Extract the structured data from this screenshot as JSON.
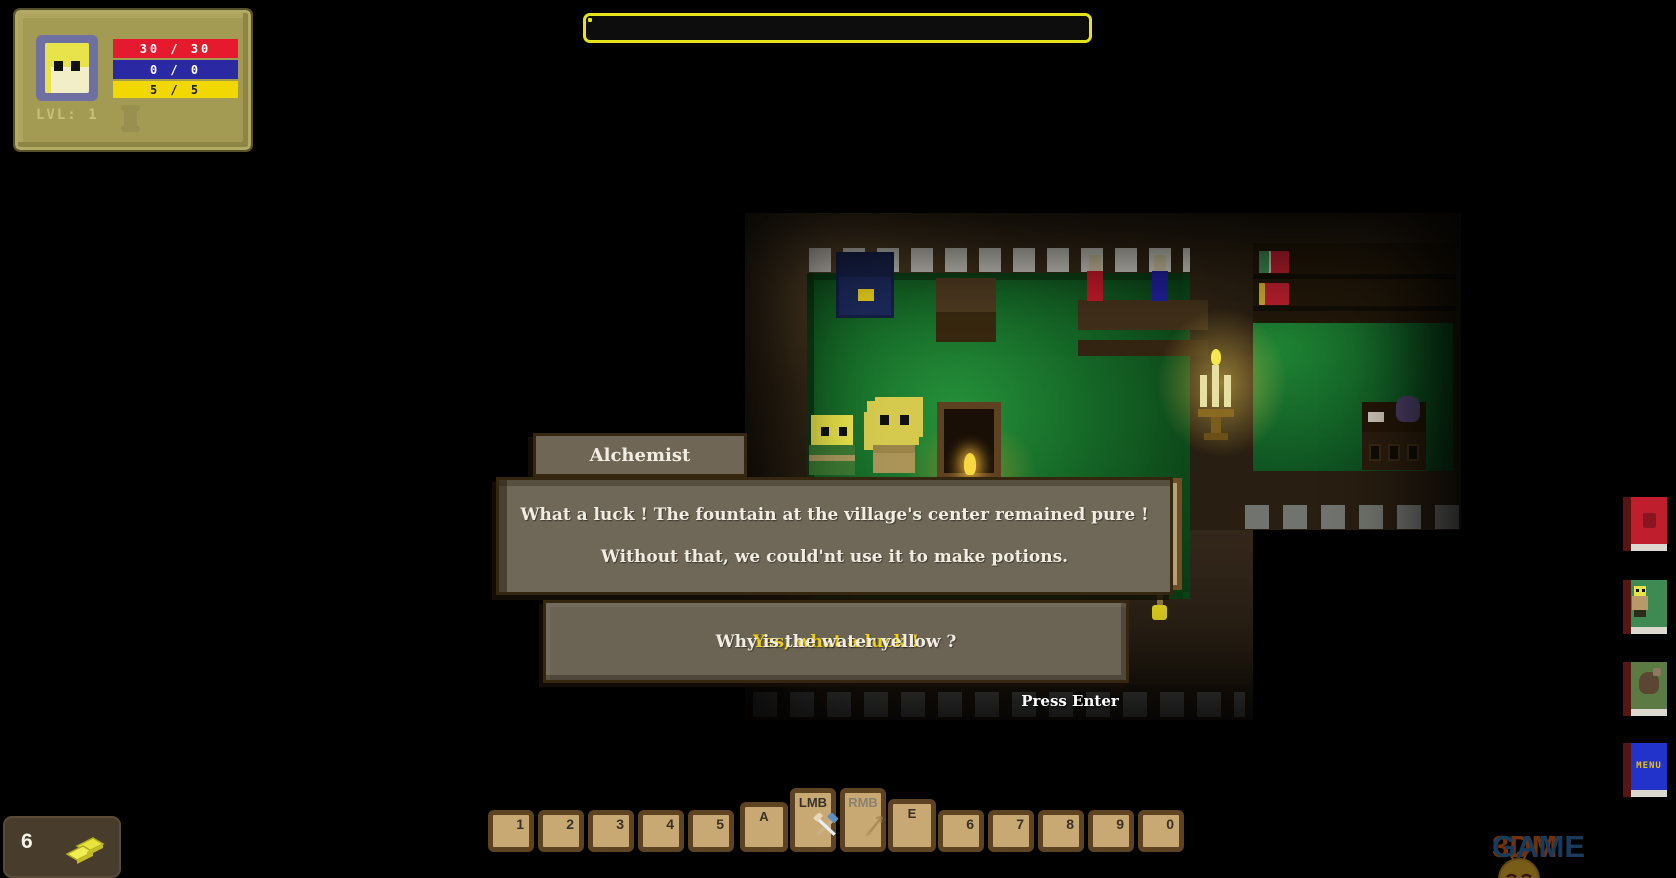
{
  "hud": {
    "stats": {
      "hp": "30 / 30",
      "mana": "0 / 0",
      "stamina": "5 / 5",
      "level": "LVL: 1",
      "colors": {
        "hp_bar": "#e51a2e",
        "mana_bar": "#2a28a2",
        "stamina_bar": "#f2d803",
        "panel": "#a39a54"
      }
    },
    "xp_bar": {
      "segments": 8,
      "filled": 0,
      "outline_color": "#e4e41c"
    },
    "gold": {
      "amount": "6",
      "icon": "gold-nuggets-icon"
    },
    "hotbar": {
      "number_keys_left": [
        "1",
        "2",
        "3",
        "4",
        "5"
      ],
      "number_keys_right": [
        "6",
        "7",
        "8",
        "9",
        "0"
      ],
      "a_key": "A",
      "e_key": "E",
      "lmb": {
        "label": "LMB",
        "icon": "hammer-pick-icon"
      },
      "rmb": {
        "label": "RMB",
        "icon": "arrow-icon",
        "state": "disabled"
      }
    },
    "menu_books": [
      {
        "name": "bestiary-book",
        "color": "#bf1f2c",
        "label": ""
      },
      {
        "name": "character-book",
        "color": "#3f8a52",
        "label": ""
      },
      {
        "name": "inventory-book",
        "color": "#5c7a44",
        "label": ""
      },
      {
        "name": "menu-book",
        "color": "#2233cc",
        "label": "MENU"
      }
    ]
  },
  "dialog": {
    "speaker": "Alchemist",
    "line1": "What a luck ! The fountain at the village's center remained pure !",
    "line2": "Without that, we could'nt use it to make potions.",
    "choice1": "Yes, what a luck !",
    "choice2": "Why is the water yellow ?",
    "choice1_color": "#f0d212",
    "hint": "Press Enter"
  },
  "scene": {
    "location": "alchemist house interior",
    "floor_color": "#1f8a33",
    "wall_color": "#3a2c1a",
    "objects": [
      "blue-cabinet",
      "wooden-table",
      "potion-shelf",
      "red-potion",
      "blue-potion",
      "candelabra",
      "bookshelf",
      "fireplace",
      "player-character",
      "alchemist-npc",
      "bed",
      "yellow-vial",
      "desk"
    ]
  },
  "watermark": {
    "brand_left": "3DM",
    "brand_right": "GAME"
  }
}
